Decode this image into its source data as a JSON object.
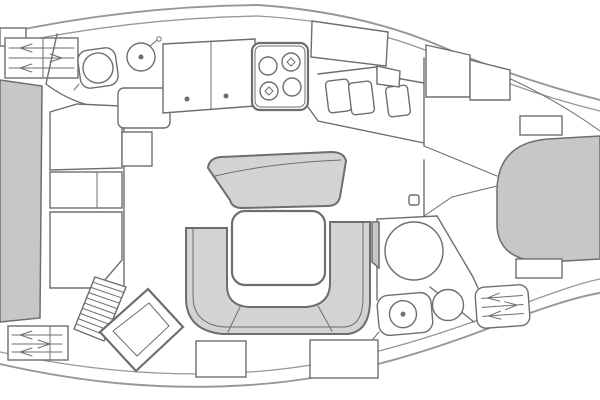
{
  "page": {
    "title": "Sailing yacht interior layout plan, top view, bow to the right"
  },
  "diagram": {
    "type": "floorplan",
    "subject": "sailboat-interior",
    "orientation": {
      "bow": "right",
      "stern": "left"
    },
    "colors": {
      "background": "#ffffff",
      "surface": "#ffffff",
      "outline": "#6e6e6e",
      "hull": "#979797",
      "berth": "#c7c7c7",
      "seating": "#d3d3d3",
      "handle": "#4f4f4f"
    },
    "areas": [
      {
        "id": "aft-cabin",
        "label": "Aft double berth with vent hatches"
      },
      {
        "id": "aft-head",
        "label": "Aft head: toilet and washbasin"
      },
      {
        "id": "storage-aft",
        "label": "Aft lockers and wardrobe"
      },
      {
        "id": "galley",
        "label": "Galley: 4-burner stove, cabinet, double sink, single sink"
      },
      {
        "id": "saloon",
        "label": "Saloon: U-shaped settee, table, forward bench, under-seat lockers"
      },
      {
        "id": "companionway",
        "label": "Companionway steps and angled chart table"
      },
      {
        "id": "forward-head",
        "label": "Forward head: shower basin, toilet, washbasin, vented locker"
      },
      {
        "id": "forward-cabin",
        "label": "Forward cabin: V-berth with side shelves"
      }
    ],
    "fixtures": [
      "double-berth",
      "v-berth",
      "toilet",
      "washbasin",
      "stove-4-burner",
      "double-sink",
      "single-sink",
      "dining-table",
      "u-settee",
      "bench-seat",
      "companionway-steps",
      "chart-table",
      "vent-hatch",
      "storage-locker",
      "bulkhead-door",
      "shower-basin"
    ]
  }
}
